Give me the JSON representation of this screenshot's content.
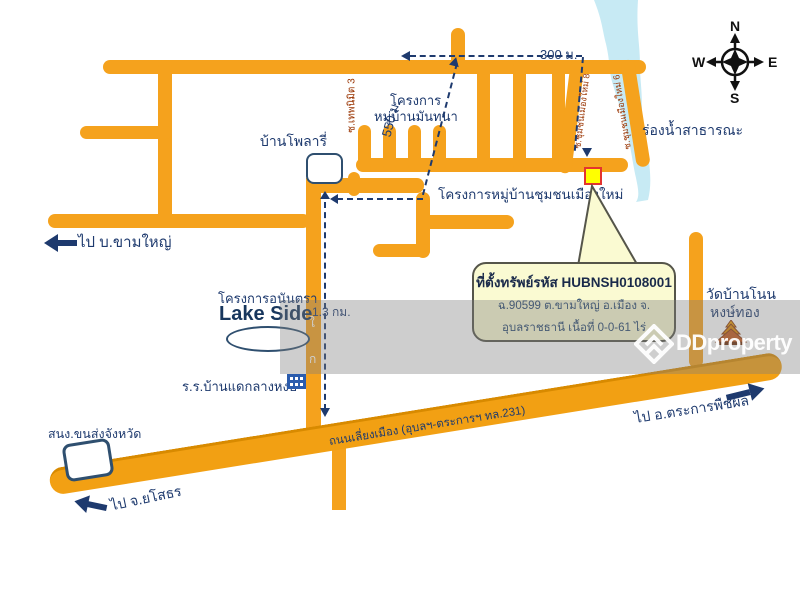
{
  "compass": {
    "n": "N",
    "e": "E",
    "s": "S",
    "w": "W"
  },
  "distances": {
    "m300": "300 ม.",
    "m550": "550 ม.",
    "km13": "1.3 กม."
  },
  "roads": {
    "ring_road_label": "ถนนเลี่ยงเมือง (อุบลฯ-ตระการฯ ทล.231)",
    "soi_thep": "ซ.เทพนิมิต 3",
    "soi8": "ซ.ชุมชนเมืองใหม่ 8",
    "soi6": "ซ.ชุมชนเมืองใหม่ 6",
    "road_glyph_1": "ใ",
    "road_glyph_2": "ก"
  },
  "places": {
    "ban_polaris": "บ้านโพลารี่",
    "mantana_line1": "โครงการ",
    "mantana_line2": "หมู่บ้านมันทนา",
    "chumchon": "โครงการหมู่บ้านชุมชนเมืองใหม่",
    "waterway": "ร่องน้ำสาธารณะ",
    "anantara": "โครงการอนันตรา",
    "lakeside": "Lake Side",
    "school": "ร.ร.บ้านแดกลางหงษ์",
    "transport_office": "สนง.ขนส่งจังหวัด",
    "temple_line1": "วัดบ้านโนน",
    "temple_line2": "หงษ์ทอง"
  },
  "directions": {
    "kham_yai": "ไป บ.ขามใหญ่",
    "yasothon": "ไป จ.ยโสธร",
    "trakan": "ไป อ.ตระการพืชผล"
  },
  "callout": {
    "line1": "ที่ตั้งทรัพย์รหัส HUBNSH0108001",
    "line2": "ฉ.90599 ต.ขามใหญ่ อ.เมือง จ.",
    "line3": "อุบลราชธานี เนื้อที่ 0-0-61 ไร่"
  },
  "watermark": {
    "brand": "DDproperty"
  },
  "colors": {
    "road": "#F5A21D",
    "navy": "#1E3A6E",
    "soi_text": "#993300",
    "pond": "#C7EAF4",
    "marker_fill": "#FFFF00",
    "marker_border": "#E3342F",
    "callout_fill": "#FAFAD2"
  }
}
